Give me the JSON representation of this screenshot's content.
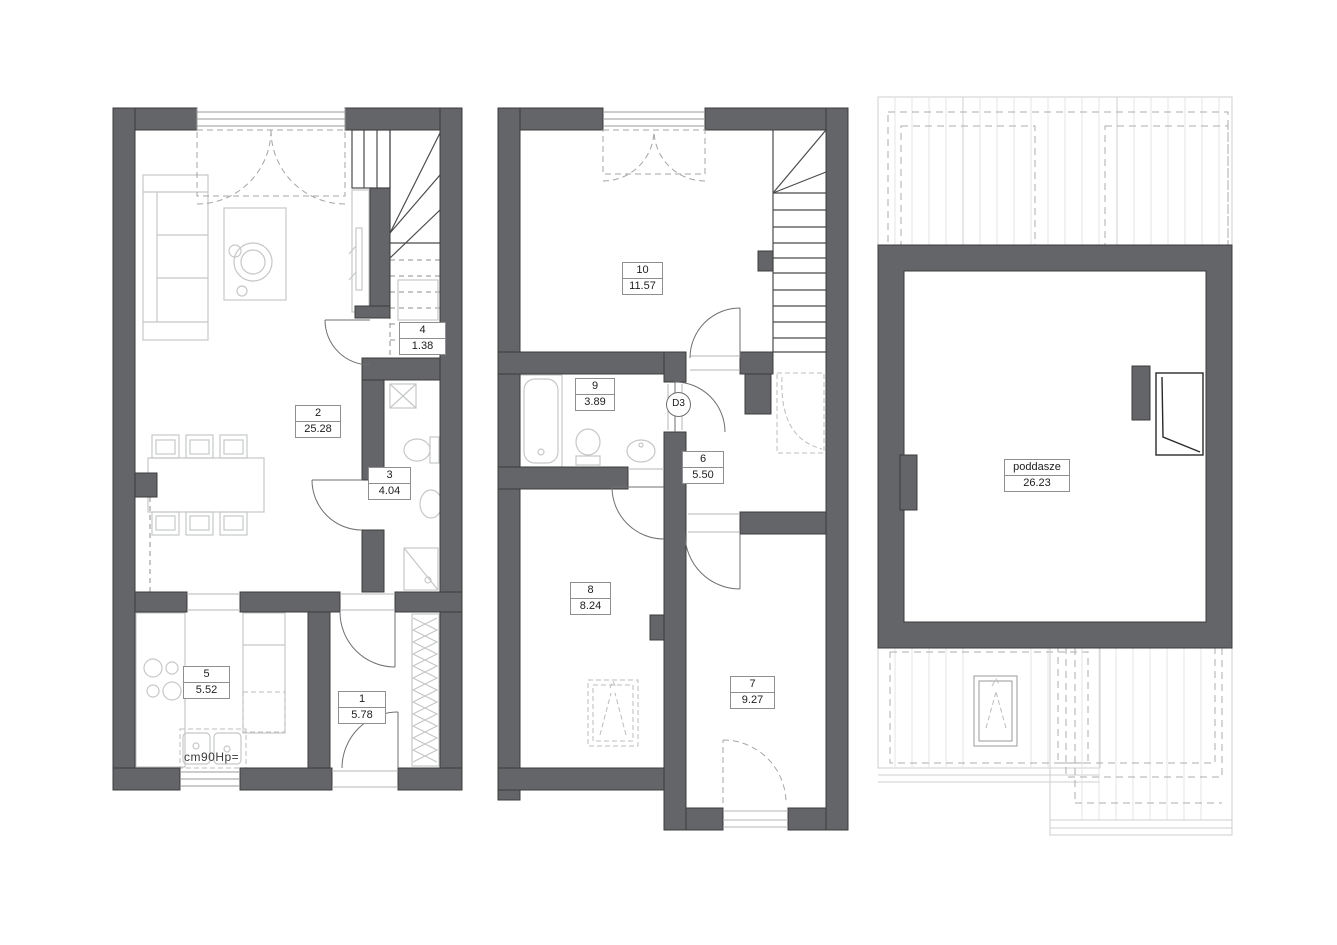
{
  "document": {
    "kind": "architectural-floor-plans",
    "background": "#ffffff"
  },
  "colors": {
    "wall": "#646568",
    "wall_outline": "#3c3c3e",
    "furniture_line": "#c6c7c8",
    "dashed_line": "#a5a5a6",
    "roof_line": "#cfcfcf",
    "label_border": "#8f8f90",
    "text": "#1c1c1c"
  },
  "plans": [
    {
      "name": "ground-floor",
      "rooms": [
        {
          "number": "1",
          "area": "5.78"
        },
        {
          "number": "2",
          "area": "25.28"
        },
        {
          "number": "3",
          "area": "4.04"
        },
        {
          "number": "4",
          "area": "1.38"
        },
        {
          "number": "5",
          "area": "5.52"
        }
      ],
      "annotation": "cm90Hp="
    },
    {
      "name": "first-floor",
      "rooms": [
        {
          "number": "6",
          "area": "5.50"
        },
        {
          "number": "7",
          "area": "9.27"
        },
        {
          "number": "8",
          "area": "8.24"
        },
        {
          "number": "9",
          "area": "3.89"
        },
        {
          "number": "10",
          "area": "11.57"
        }
      ],
      "door_label": "D3"
    },
    {
      "name": "attic",
      "rooms": [
        {
          "number": "poddasze",
          "area": "26.23"
        }
      ]
    }
  ]
}
